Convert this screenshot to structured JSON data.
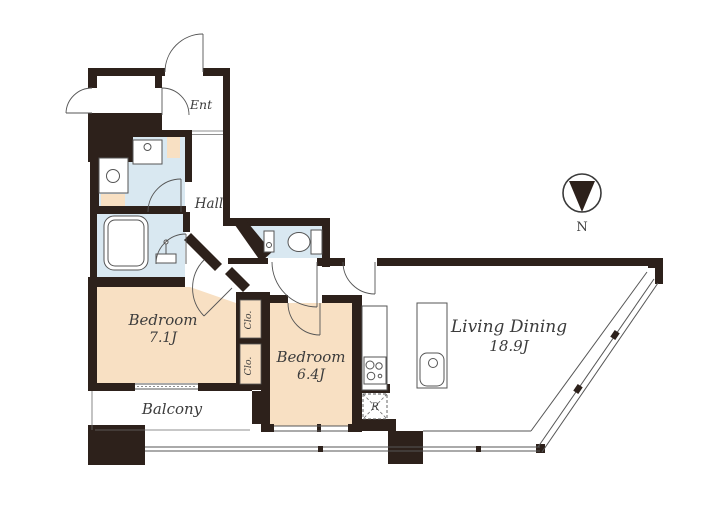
{
  "title": "Apartment floor plan",
  "colors": {
    "wall": "#2d211b",
    "room_peach": "#f8e0c3",
    "wet_area_blue": "#d9e8f1",
    "line": "#555555",
    "text": "#3c3c3c"
  },
  "rooms": {
    "entrance": {
      "label": "Ent"
    },
    "hall": {
      "label": "Hall"
    },
    "bedroom_main": {
      "label": "Bedroom",
      "size": "7.1J"
    },
    "bedroom_second": {
      "label": "Bedroom",
      "size": "6.4J"
    },
    "living_dining": {
      "label": "Living Dining",
      "size": "18.9J"
    },
    "balcony": {
      "label": "Balcony"
    },
    "closet_upper": {
      "label": "Clo."
    },
    "closet_lower": {
      "label": "Clo."
    },
    "refrigerator_space": {
      "label": "R"
    },
    "compass_north": {
      "label": "N"
    }
  },
  "fixtures": [
    "bathtub",
    "bathroom-washstand",
    "washbasin-counter",
    "washing-machine-pan",
    "toilet",
    "toilet-hand-basin",
    "kitchen-counter",
    "gas-stove",
    "kitchen-island-sink",
    "refrigerator-space",
    "entrance-door",
    "balcony-railing",
    "north-compass"
  ]
}
